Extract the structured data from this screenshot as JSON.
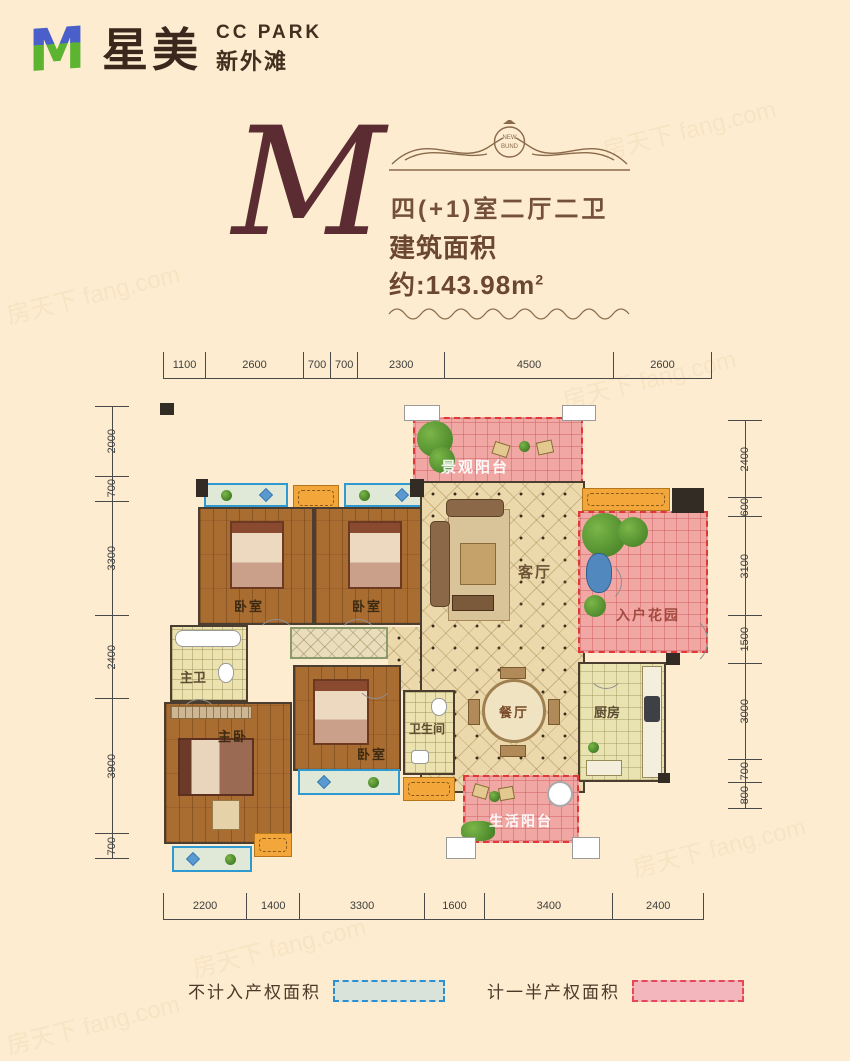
{
  "header": {
    "brand": "星美",
    "brand_en": "CC PARK",
    "brand_sub": "新外滩"
  },
  "title": {
    "letter": "M",
    "badge": "NEW BUND",
    "layout": "四(+1)室二厅二卫",
    "area_label": "建筑面积约:143.98m",
    "area_sup": "2"
  },
  "dimensions": {
    "top": [
      "1100",
      "2600",
      "700",
      "700",
      "2300",
      "4500",
      "2600"
    ],
    "bottom": [
      "2200",
      "1400",
      "3300",
      "1600",
      "3400",
      "2400"
    ],
    "left": [
      "2000",
      "700",
      "3300",
      "2400",
      "3900",
      "700"
    ],
    "right": [
      "2400",
      "600",
      "3100",
      "1500",
      "3000",
      "700",
      "800"
    ]
  },
  "rooms": {
    "view_balcony": "景观阳台",
    "bedroom1": "卧室",
    "bedroom2": "卧室",
    "living": "客厅",
    "entry_garden": "入户花园",
    "master_bath": "主卫",
    "master_bedroom": "主卧",
    "bedroom3": "卧室",
    "bathroom": "卫生间",
    "dining": "餐厅",
    "kitchen": "厨房",
    "service_balcony": "生活阳台"
  },
  "legend": [
    {
      "label": "不计入产权面积",
      "fill": "#d9e3da",
      "border": "#2d8fd0"
    },
    {
      "label": "计一半产权面积",
      "fill": "#f3b6bd",
      "border": "#e5485a"
    }
  ],
  "watermark": "房天下 fang.com",
  "colors": {
    "background": "#fdeccf",
    "title_brown": "#5c2c33",
    "accent_red_dashed": "#e03838",
    "accent_blue": "#2e9acf",
    "pink_half_area": "#f1a8a4",
    "wood_floor": "#a96c31",
    "tile_floor": "#ecd9ab",
    "orange_ac": "#f3a63a",
    "wall": "#4b3e30"
  }
}
